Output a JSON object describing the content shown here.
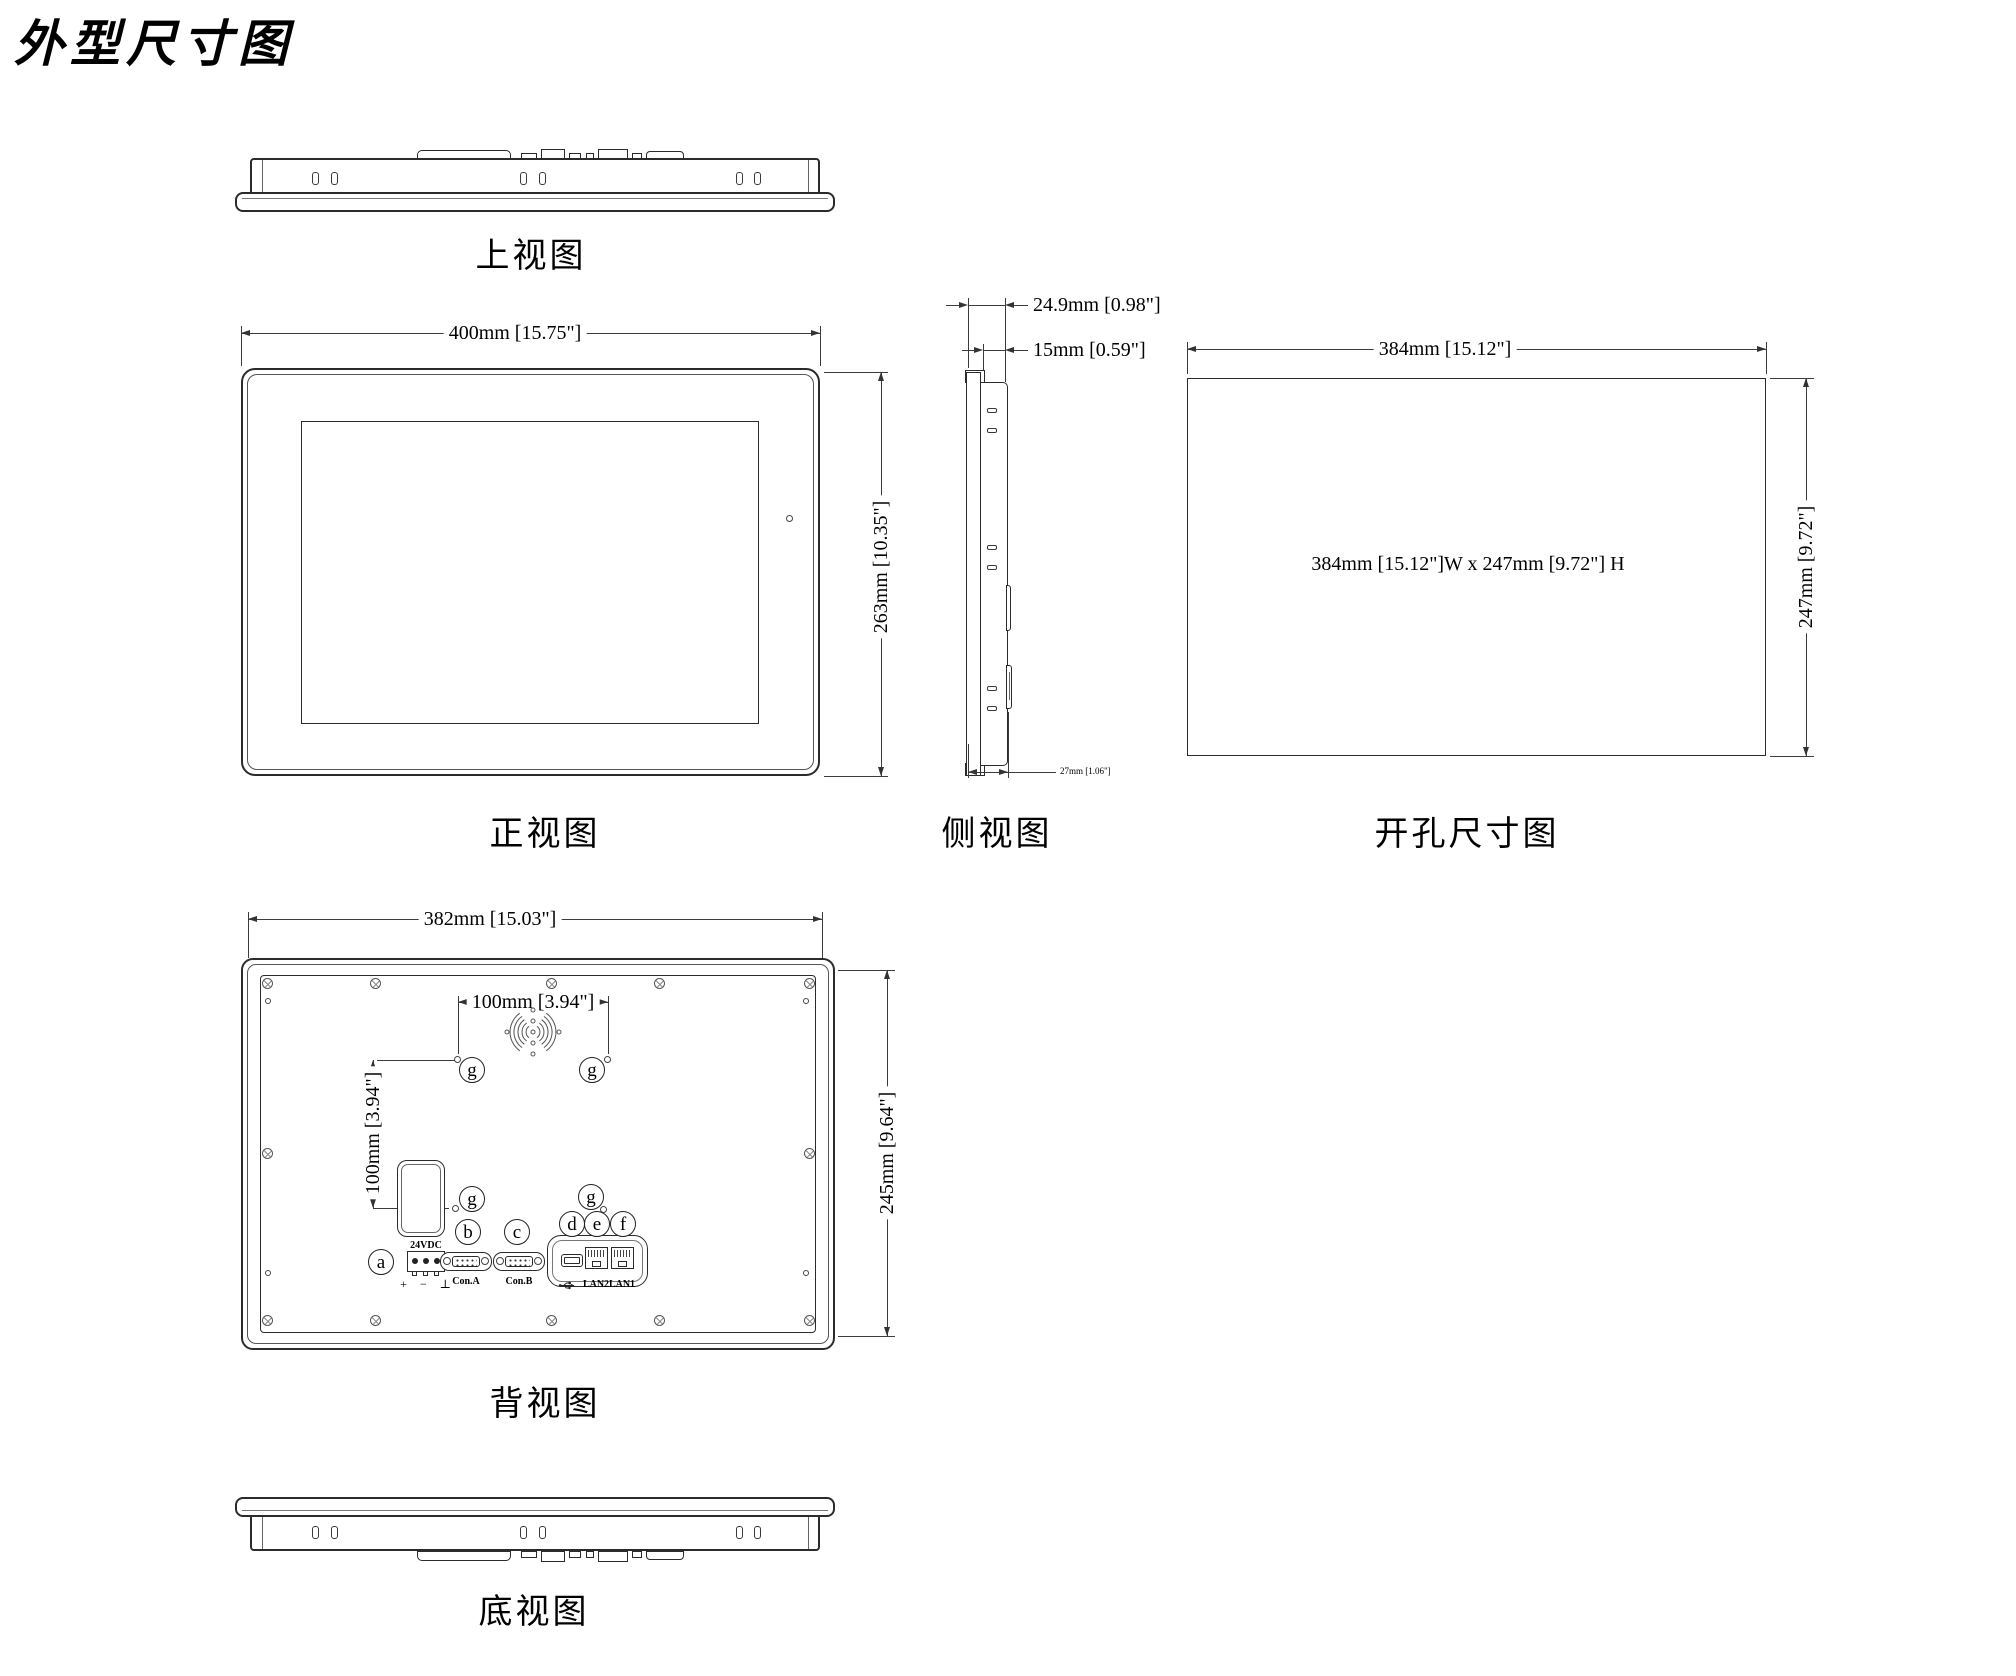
{
  "title": "外型尺寸图",
  "colors": {
    "line": "#2b2b2b",
    "dim_line": "#3c3c3c",
    "text": "#000000",
    "background": "#ffffff"
  },
  "views": {
    "top_view": {
      "label": "上视图"
    },
    "front_view": {
      "label": "正视图",
      "width_dim": "400mm [15.75\"]",
      "height_dim": "263mm [10.35\"]"
    },
    "side_view": {
      "label": "侧视图",
      "depth_dim": "24.9mm [0.98\"]",
      "bezel_depth_dim": "15mm [0.59\"]",
      "total_depth_dim": "27mm [1.06\"]"
    },
    "cutout_view": {
      "label": "开孔尺寸图",
      "width_dim": "384mm [15.12\"]",
      "height_dim": "247mm [9.72\"]",
      "note": "384mm [15.12\"]W x 247mm [9.72\"] H"
    },
    "rear_view": {
      "label": "背视图",
      "width_dim": "382mm [15.03\"]",
      "height_dim": "245mm [9.64\"]",
      "vesa_width_dim": "100mm [3.94\"]",
      "vesa_height_dim": "100mm [3.94\"]",
      "power_voltage": "24VDC",
      "power_symbols": "+ − ⊥",
      "con_a": "Con.A",
      "con_b": "Con.B",
      "lan2": "LAN2",
      "lan1": "LAN1",
      "callout_a": "a",
      "callout_b": "b",
      "callout_c": "c",
      "callout_d": "d",
      "callout_e": "e",
      "callout_f": "f",
      "callout_g": "g"
    },
    "bottom_view": {
      "label": "底视图"
    }
  }
}
